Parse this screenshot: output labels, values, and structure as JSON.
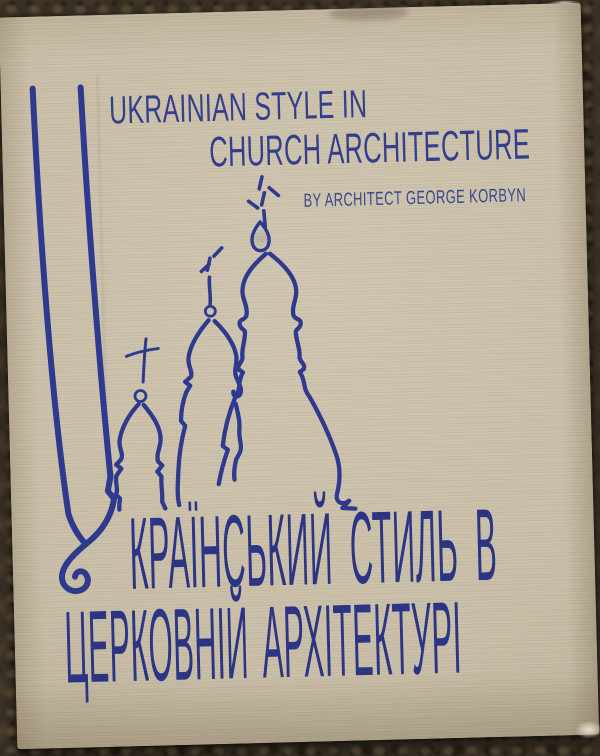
{
  "book_cover": {
    "english_title": {
      "line1": "UKRAINIAN STYLE IN",
      "line2": "CHURCH ARCHITECTURE"
    },
    "byline": "BY ARCHITECT GEORGE KORBYN",
    "ukrainian_title": {
      "initial": "У",
      "line1_rest": "КРАЇНСЬКИЙ СТИЛЬ В",
      "line2": "ЦЕРКОВНІЙ АРХІТЕКТУРІ",
      "full_text": "УКРАЇНСЬКИЙ СТИЛЬ В ЦЕРКОВНІЙ АРХІТЕКТУРІ"
    },
    "illustration": {
      "name": "three-onion-dome-churches-line-drawing"
    },
    "colors": {
      "ink_blue": "#2e3a8e",
      "cover_beige": "#c9bea7",
      "backdrop_brown": "#3a3126"
    }
  }
}
